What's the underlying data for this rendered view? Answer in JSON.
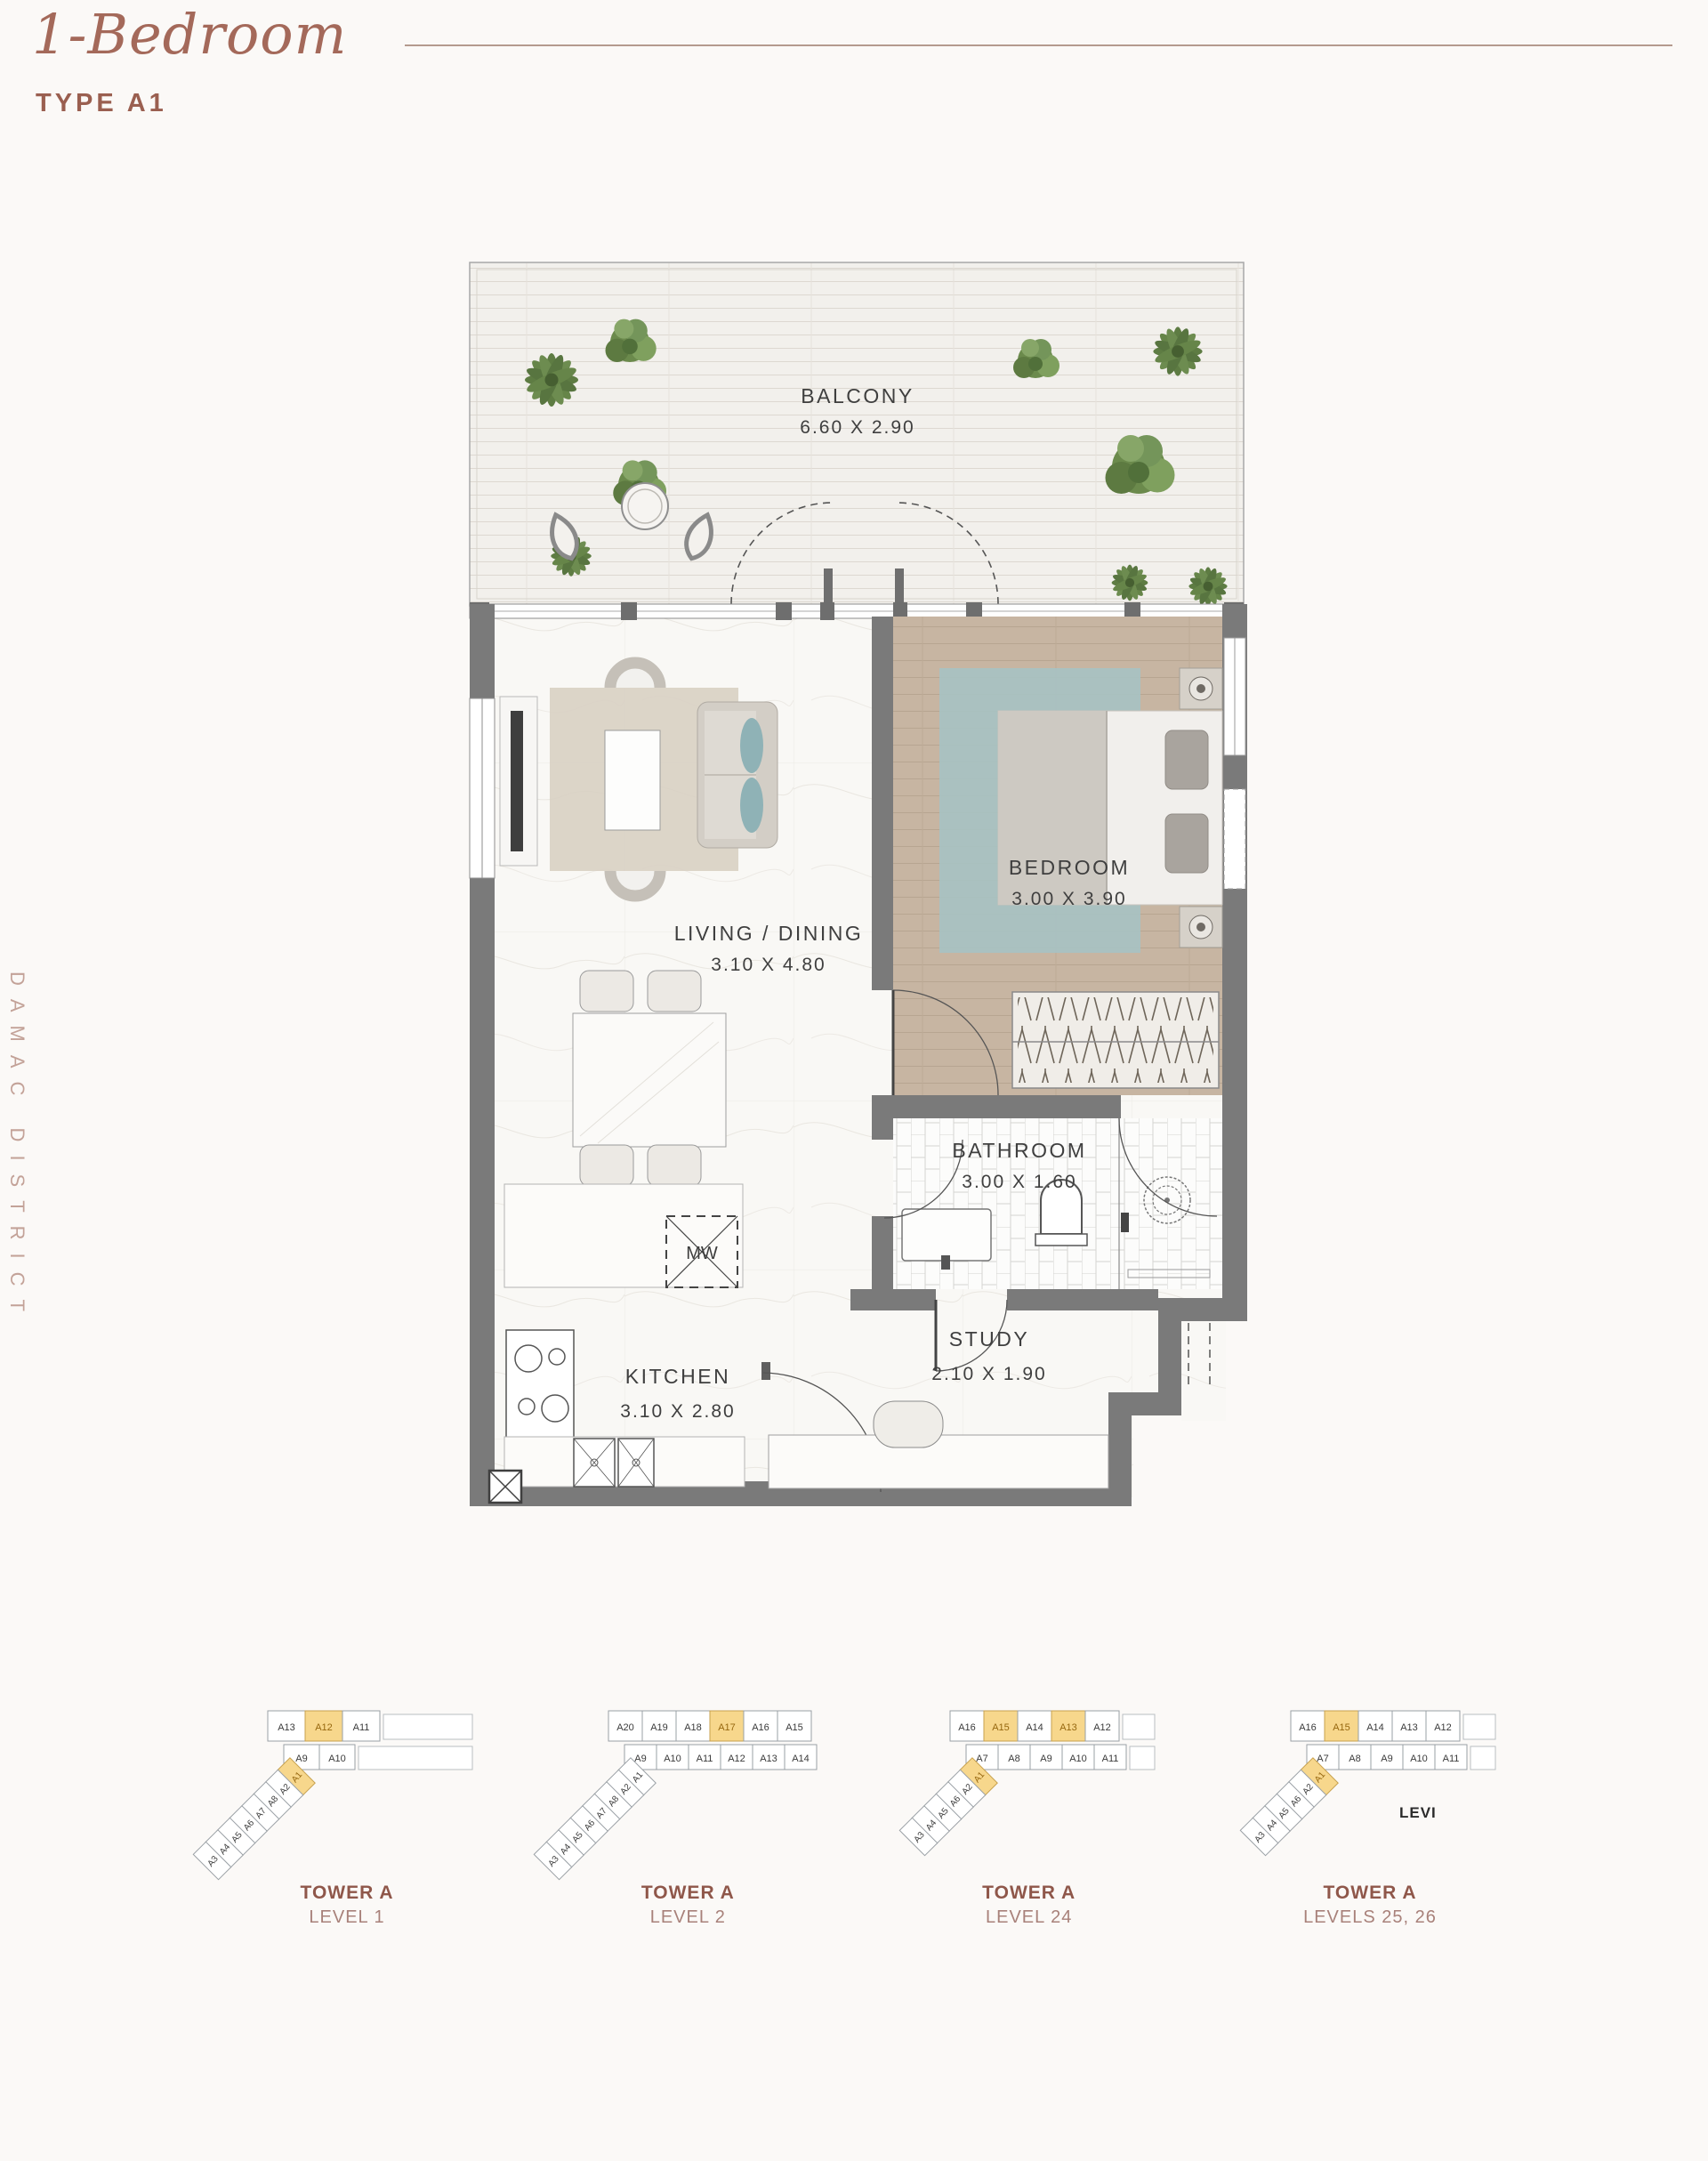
{
  "header": {
    "title": "1-Bedroom",
    "subtitle": "TYPE A1"
  },
  "side_text": "DAMAC DISTRICT",
  "floor_plan": {
    "rooms": {
      "balcony": {
        "name": "BALCONY",
        "dims": "6.60 X 2.90"
      },
      "living": {
        "name": "LIVING / DINING",
        "dims": "3.10 X 4.80"
      },
      "bedroom": {
        "name": "BEDROOM",
        "dims": "3.00 X 3.90"
      },
      "bathroom": {
        "name": "BATHROOM",
        "dims": "3.00 X 1.60"
      },
      "kitchen": {
        "name": "KITCHEN",
        "dims": "3.10 X 2.80"
      },
      "study": {
        "name": "STUDY",
        "dims": "2.10 X 1.90"
      }
    },
    "labels": {
      "microwave": "MW"
    }
  },
  "key_plans": [
    {
      "tower": "TOWER A",
      "level": "LEVEL 1",
      "top": [
        {
          "label": "A13"
        },
        {
          "label": "A12",
          "highlight": true
        },
        {
          "label": "A11"
        }
      ],
      "mid": [
        {
          "label": "A9"
        },
        {
          "label": "A10"
        }
      ],
      "wing": [
        {
          "label": "A1",
          "highlight": true
        },
        {
          "label": "A2"
        },
        {
          "label": "A8"
        },
        {
          "label": "A7"
        },
        {
          "label": "A6"
        },
        {
          "label": "A5"
        },
        {
          "label": "A4"
        },
        {
          "label": "A3"
        }
      ]
    },
    {
      "tower": "TOWER A",
      "level": "LEVEL 2",
      "top": [
        {
          "label": "A20"
        },
        {
          "label": "A19"
        },
        {
          "label": "A18"
        },
        {
          "label": "A17",
          "highlight": true
        },
        {
          "label": "A16"
        },
        {
          "label": "A15"
        }
      ],
      "mid": [
        {
          "label": "A9"
        },
        {
          "label": "A10"
        },
        {
          "label": "A11"
        },
        {
          "label": "A12"
        },
        {
          "label": "A13"
        },
        {
          "label": "A14"
        }
      ],
      "wing": [
        {
          "label": "A1"
        },
        {
          "label": "A2"
        },
        {
          "label": "A8"
        },
        {
          "label": "A7"
        },
        {
          "label": "A6"
        },
        {
          "label": "A5"
        },
        {
          "label": "A4"
        },
        {
          "label": "A3"
        }
      ]
    },
    {
      "tower": "TOWER A",
      "level": "LEVEL 24",
      "top": [
        {
          "label": "A16"
        },
        {
          "label": "A15",
          "highlight": true
        },
        {
          "label": "A14"
        },
        {
          "label": "A13",
          "highlight": true
        },
        {
          "label": "A12"
        }
      ],
      "mid": [
        {
          "label": "A7"
        },
        {
          "label": "A8"
        },
        {
          "label": "A9"
        },
        {
          "label": "A10"
        },
        {
          "label": "A11"
        }
      ],
      "wing": [
        {
          "label": "A1",
          "highlight": true
        },
        {
          "label": "A2"
        },
        {
          "label": "A6"
        },
        {
          "label": "A5"
        },
        {
          "label": "A4"
        },
        {
          "label": "A3"
        }
      ]
    },
    {
      "tower": "TOWER A",
      "level": "LEVELS 25, 26",
      "top": [
        {
          "label": "A16"
        },
        {
          "label": "A15",
          "highlight": true
        },
        {
          "label": "A14"
        },
        {
          "label": "A13"
        },
        {
          "label": "A12"
        }
      ],
      "mid": [
        {
          "label": "A7"
        },
        {
          "label": "A8"
        },
        {
          "label": "A9"
        },
        {
          "label": "A10"
        },
        {
          "label": "A11"
        }
      ],
      "wing": [
        {
          "label": "A1",
          "highlight": true
        },
        {
          "label": "A2"
        },
        {
          "label": "A6"
        },
        {
          "label": "A5"
        },
        {
          "label": "A4"
        },
        {
          "label": "A3"
        }
      ],
      "note": "LEVI"
    }
  ],
  "colors": {
    "accent": "#a4695a",
    "subtitle": "#9a5f50",
    "rule": "#b49a8e",
    "side_text": "#c3a298",
    "wall": "#7a7a7a",
    "wood_floor": "#c7b5a2",
    "rug_teal": "#a7c2c2",
    "keyplan_highlight": "#f7d78c",
    "keyplan_highlight_border": "#c7a14e",
    "tower_label": "#8f574a",
    "level_label": "#a8817a"
  }
}
